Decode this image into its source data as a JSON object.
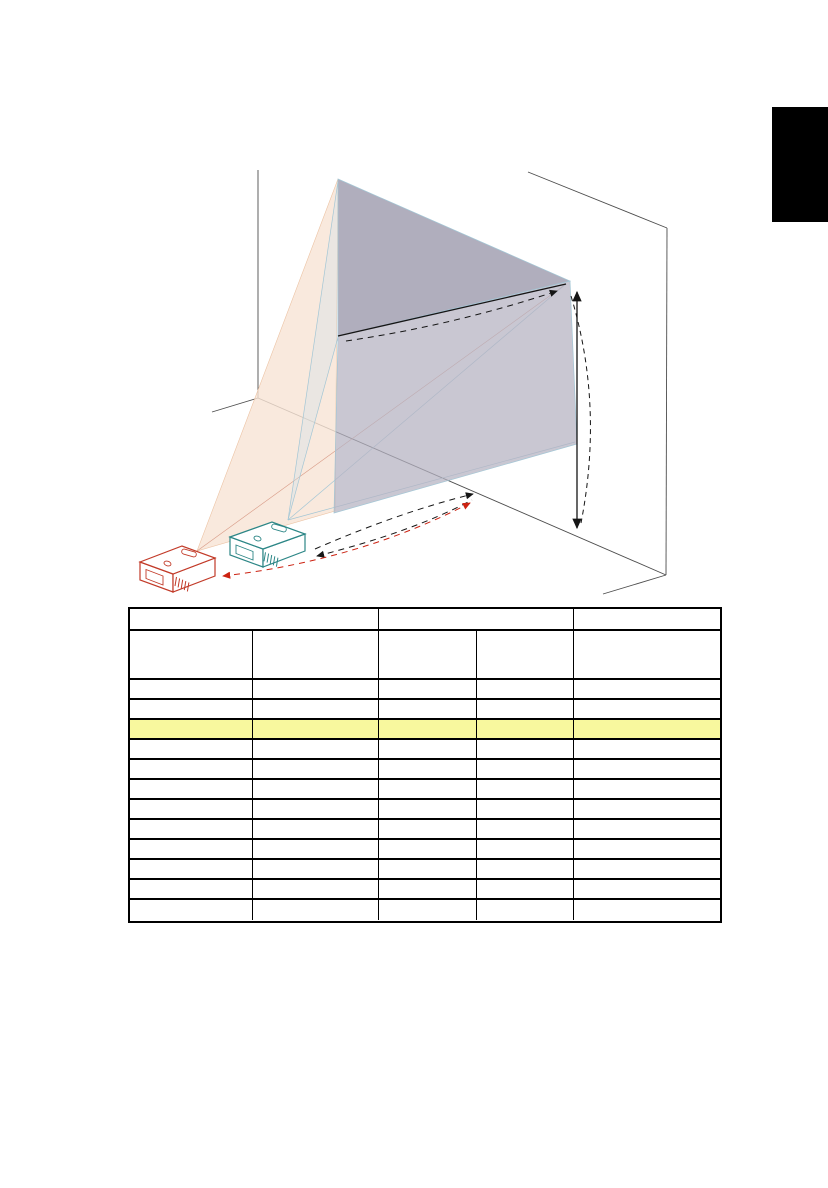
{
  "page": {
    "width": 828,
    "height": 1188,
    "background": "#ffffff"
  },
  "side_tab": {
    "color": "#000000"
  },
  "figure": {
    "type": "projection-distance-diagram",
    "elements": [
      "room-wall-outline",
      "large-screen",
      "small-screen-face",
      "red-projection-cone",
      "teal-projection-cone",
      "screen-diagonal-line",
      "screen-height-arrow",
      "projection-distance-arrows",
      "red-projector",
      "teal-projector"
    ],
    "colors": {
      "wall_line": "#4d4d4d",
      "screen_fill_upper": "#a5a3b4",
      "screen_fill_lower": "#b4b2c0",
      "screen_edge": "#a3c6d5",
      "cone_fill": "#f8e4d5",
      "cone_edge": "#ecc3a4",
      "cone_blue_fill": "#cfe3ea",
      "faint_red_line": "#d89a86",
      "red_projector": "#c23a28",
      "teal_projector": "#2c8686",
      "arrow": "#151515",
      "red_arrow": "#cc2211"
    }
  },
  "table": {
    "border_color": "#000000",
    "highlight_color": "#f8f89e",
    "columns_px": [
      123,
      126,
      98,
      97,
      146
    ],
    "header_row1": {
      "height_px": 22,
      "cells": [
        {
          "span": 2,
          "text": ""
        },
        {
          "span": 2,
          "text": ""
        },
        {
          "span": 1,
          "text": ""
        }
      ]
    },
    "header_row2": {
      "height_px": 49,
      "cells": [
        "",
        "",
        "",
        "",
        ""
      ]
    },
    "body": {
      "row_height_px": 20,
      "rows": [
        [
          "",
          "",
          "",
          "",
          ""
        ],
        [
          "",
          "",
          "",
          "",
          ""
        ],
        [
          "",
          "",
          "",
          "",
          ""
        ],
        [
          "",
          "",
          "",
          "",
          ""
        ],
        [
          "",
          "",
          "",
          "",
          ""
        ],
        [
          "",
          "",
          "",
          "",
          ""
        ],
        [
          "",
          "",
          "",
          "",
          ""
        ],
        [
          "",
          "",
          "",
          "",
          ""
        ],
        [
          "",
          "",
          "",
          "",
          ""
        ],
        [
          "",
          "",
          "",
          "",
          ""
        ],
        [
          "",
          "",
          "",
          "",
          ""
        ],
        [
          "",
          "",
          "",
          "",
          ""
        ]
      ]
    },
    "highlighted_row_index": 2
  }
}
